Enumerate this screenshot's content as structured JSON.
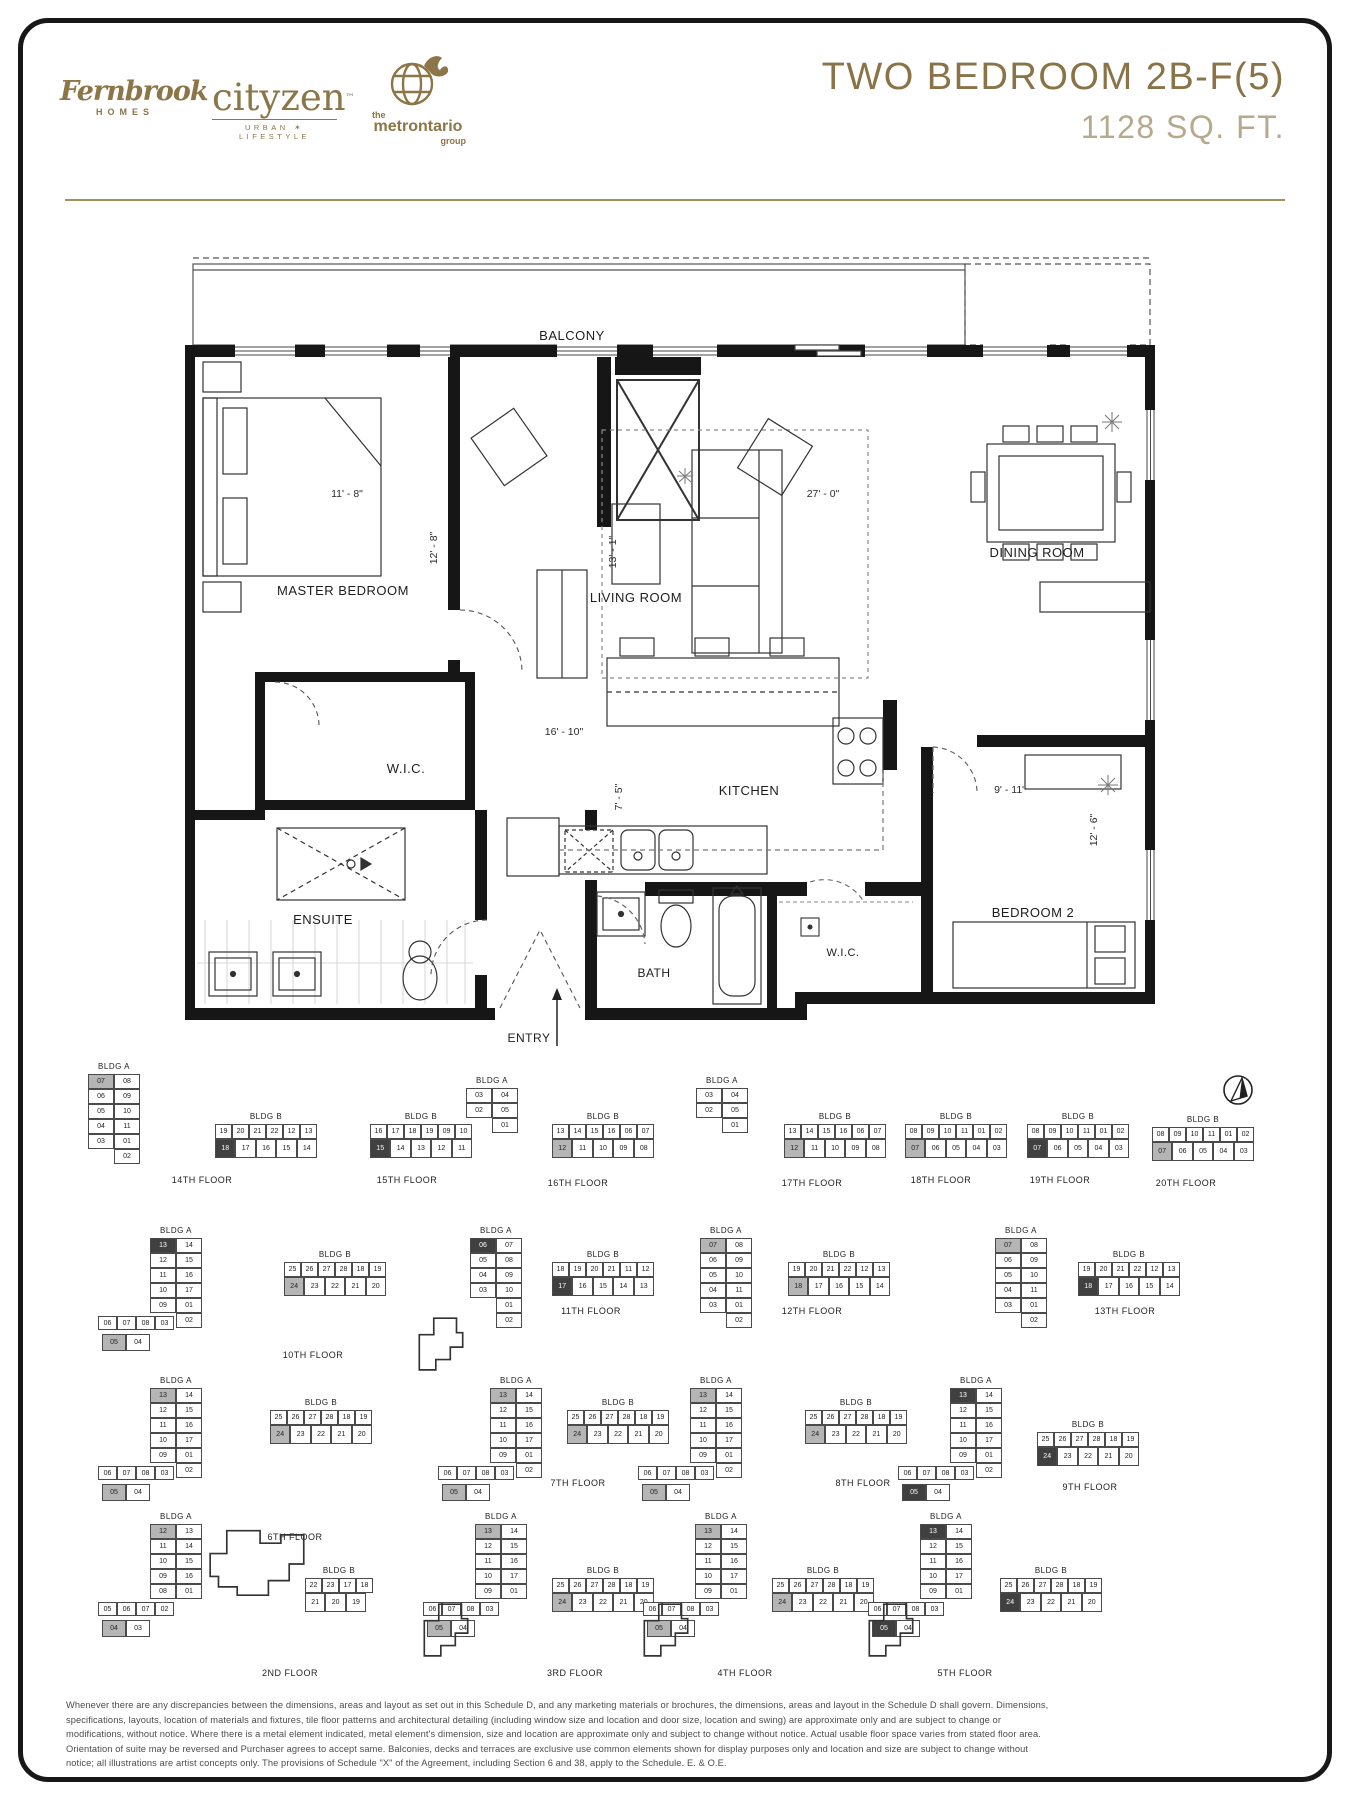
{
  "header": {
    "title": "TWO BEDROOM 2B-F(5)",
    "subtitle": "1128 SQ. FT.",
    "logos": {
      "fernbrook_line1": "Fernbrook",
      "fernbrook_line2": "HOMES",
      "cityzen_line1": "cityzen",
      "cityzen_tm": "™",
      "cityzen_line2": "URBAN ✶ LIFESTYLE",
      "metro_line0": "the",
      "metro_line1": "metrontario",
      "metro_line2": "group"
    },
    "accent_color": "#8a7347",
    "subtitle_color": "#b7a98d"
  },
  "floorplan": {
    "rooms": [
      {
        "t": "BALCONY",
        "x": 407,
        "y": 110,
        "fs": 13
      },
      {
        "t": "MASTER BEDROOM",
        "x": 178,
        "y": 365,
        "fs": 13
      },
      {
        "t": "LIVING ROOM",
        "x": 471,
        "y": 372,
        "fs": 13
      },
      {
        "t": "DINING ROOM",
        "x": 872,
        "y": 327,
        "fs": 13
      },
      {
        "t": "W.I.C.",
        "x": 241,
        "y": 543,
        "fs": 13
      },
      {
        "t": "KITCHEN",
        "x": 584,
        "y": 565,
        "fs": 13
      },
      {
        "t": "ENSUITE",
        "x": 158,
        "y": 694,
        "fs": 13
      },
      {
        "t": "BATH",
        "x": 489,
        "y": 747,
        "fs": 12
      },
      {
        "t": "W.I.C.",
        "x": 678,
        "y": 726,
        "fs": 11
      },
      {
        "t": "BEDROOM 2",
        "x": 868,
        "y": 687,
        "fs": 13
      },
      {
        "t": "ENTRY",
        "x": 364,
        "y": 812,
        "fs": 12
      }
    ],
    "dims": [
      {
        "t": "11' - 8\"",
        "x": 182,
        "y": 267,
        "rot": 0
      },
      {
        "t": "12' - 8\"",
        "x": 272,
        "y": 318,
        "rot": -90
      },
      {
        "t": "13' - 1\"",
        "x": 451,
        "y": 322,
        "rot": -90
      },
      {
        "t": "27' - 0\"",
        "x": 658,
        "y": 267,
        "rot": 0
      },
      {
        "t": "16' - 10\"",
        "x": 399,
        "y": 505,
        "rot": 0
      },
      {
        "t": "7' - 5\"",
        "x": 457,
        "y": 567,
        "rot": -90
      },
      {
        "t": "9' - 11\"",
        "x": 845,
        "y": 563,
        "rot": 0
      },
      {
        "t": "12' - 6\"",
        "x": 932,
        "y": 600,
        "rot": -90
      }
    ]
  },
  "keyplans": {
    "bldga_label": "BLDG A",
    "bldgb_label": "BLDG B",
    "groups": [
      {
        "floor": "14TH FLOOR",
        "fx": 202,
        "fy": 1175,
        "a": {
          "x": 88,
          "y": 1062,
          "left": [
            "07*g",
            "06",
            "05",
            "04",
            "03"
          ],
          "right": [
            "08",
            "09",
            "10",
            "11",
            "01",
            "02"
          ]
        },
        "b": {
          "x": 215,
          "y": 1112,
          "top": [
            "19",
            "20",
            "21",
            "22",
            "12",
            "13"
          ],
          "bottom": [
            "18*d",
            "17",
            "16",
            "15",
            "14"
          ]
        }
      },
      {
        "floor": "15TH FLOOR",
        "fx": 407,
        "fy": 1175,
        "b": {
          "x": 370,
          "y": 1112,
          "top": [
            "16",
            "17",
            "18",
            "19",
            "09",
            "10"
          ],
          "bottom": [
            "15*d",
            "14",
            "13",
            "12",
            "11"
          ]
        }
      },
      {
        "floor": "16TH FLOOR",
        "fx": 578,
        "fy": 1178,
        "a": {
          "x": 466,
          "y": 1076,
          "left": [
            "03",
            "02"
          ],
          "right": [
            "04",
            "05",
            "01"
          ]
        },
        "b": {
          "x": 552,
          "y": 1112,
          "top": [
            "13",
            "14",
            "15",
            "16",
            "06",
            "07"
          ],
          "bottom": [
            "12*g",
            "11",
            "10",
            "09",
            "08"
          ]
        }
      },
      {
        "floor": "17TH FLOOR",
        "fx": 812,
        "fy": 1178,
        "a": {
          "x": 696,
          "y": 1076,
          "left": [
            "03",
            "02"
          ],
          "right": [
            "04",
            "05",
            "01"
          ]
        },
        "b": {
          "x": 784,
          "y": 1112,
          "top": [
            "13",
            "14",
            "15",
            "16",
            "06",
            "07"
          ],
          "bottom": [
            "12*g",
            "11",
            "10",
            "09",
            "08"
          ]
        }
      },
      {
        "floor": "18TH FLOOR",
        "fx": 941,
        "fy": 1175,
        "b": {
          "x": 905,
          "y": 1112,
          "top": [
            "08",
            "09",
            "10",
            "11",
            "01",
            "02"
          ],
          "bottom": [
            "07*g",
            "06",
            "05",
            "04",
            "03"
          ]
        }
      },
      {
        "floor": "19TH FLOOR",
        "fx": 1060,
        "fy": 1175,
        "b": {
          "x": 1027,
          "y": 1112,
          "top": [
            "08",
            "09",
            "10",
            "11",
            "01",
            "02"
          ],
          "bottom": [
            "07*d",
            "06",
            "05",
            "04",
            "03"
          ]
        }
      },
      {
        "floor": "20TH FLOOR",
        "fx": 1186,
        "fy": 1178,
        "b": {
          "x": 1152,
          "y": 1115,
          "top": [
            "08",
            "09",
            "10",
            "11",
            "01",
            "02"
          ],
          "bottom": [
            "07*g",
            "06",
            "05",
            "04",
            "03"
          ]
        }
      },
      {
        "floor": "10TH FLOOR",
        "fx": 313,
        "fy": 1350,
        "a": {
          "x": 150,
          "y": 1226,
          "left": [
            "13*d",
            "12",
            "11",
            "10",
            "09"
          ],
          "right": [
            "14",
            "15",
            "16",
            "17",
            "01",
            "02"
          ],
          "arm": [
            "06",
            "07",
            "08",
            "03"
          ],
          "arm2": [
            "05*g",
            "04"
          ]
        },
        "b": {
          "x": 284,
          "y": 1250,
          "top": [
            "25",
            "26",
            "27",
            "28",
            "18",
            "19"
          ],
          "bottom": [
            "24*g",
            "23",
            "22",
            "21",
            "20"
          ]
        }
      },
      {
        "floor": "11TH FLOOR",
        "fx": 591,
        "fy": 1306,
        "a": {
          "x": 470,
          "y": 1226,
          "left": [
            "06*d",
            "05",
            "04",
            "03"
          ],
          "right": [
            "07",
            "08",
            "09",
            "10",
            "01",
            "02"
          ],
          "podium": "small-left"
        },
        "b": {
          "x": 552,
          "y": 1250,
          "top": [
            "18",
            "19",
            "20",
            "21",
            "11",
            "12"
          ],
          "bottom": [
            "17*d",
            "16",
            "15",
            "14",
            "13"
          ]
        }
      },
      {
        "floor": "12TH FLOOR",
        "fx": 812,
        "fy": 1306,
        "a": {
          "x": 700,
          "y": 1226,
          "left": [
            "07*g",
            "06",
            "05",
            "04",
            "03"
          ],
          "right": [
            "08",
            "09",
            "10",
            "11",
            "01",
            "02"
          ]
        },
        "b": {
          "x": 788,
          "y": 1250,
          "top": [
            "19",
            "20",
            "21",
            "22",
            "12",
            "13"
          ],
          "bottom": [
            "18*g",
            "17",
            "16",
            "15",
            "14"
          ]
        }
      },
      {
        "floor": "13TH FLOOR",
        "fx": 1125,
        "fy": 1306,
        "a": {
          "x": 995,
          "y": 1226,
          "left": [
            "07*g",
            "06",
            "05",
            "04",
            "03"
          ],
          "right": [
            "08",
            "09",
            "10",
            "11",
            "01",
            "02"
          ]
        },
        "b": {
          "x": 1078,
          "y": 1250,
          "top": [
            "19",
            "20",
            "21",
            "22",
            "12",
            "13"
          ],
          "bottom": [
            "18*d",
            "17",
            "16",
            "15",
            "14"
          ]
        }
      },
      {
        "floor": "6TH FLOOR",
        "fx": 295,
        "fy": 1532,
        "a": {
          "x": 150,
          "y": 1376,
          "left": [
            "13*g",
            "12",
            "11",
            "10",
            "09"
          ],
          "right": [
            "14",
            "15",
            "16",
            "17",
            "01",
            "02"
          ],
          "arm": [
            "06",
            "07",
            "08",
            "03"
          ],
          "arm2": [
            "05*g",
            "04"
          ]
        },
        "b": {
          "x": 270,
          "y": 1398,
          "top": [
            "25",
            "26",
            "27",
            "28",
            "18",
            "19"
          ],
          "bottom": [
            "24*g",
            "23",
            "22",
            "21",
            "20"
          ]
        }
      },
      {
        "floor": "7TH FLOOR",
        "fx": 578,
        "fy": 1478,
        "a": {
          "x": 490,
          "y": 1376,
          "left": [
            "13*g",
            "12",
            "11",
            "10",
            "09"
          ],
          "right": [
            "14",
            "15",
            "16",
            "17",
            "01",
            "02"
          ],
          "arm": [
            "06",
            "07",
            "08",
            "03"
          ],
          "arm2": [
            "05*g",
            "04"
          ]
        },
        "b": {
          "x": 567,
          "y": 1398,
          "top": [
            "25",
            "26",
            "27",
            "28",
            "18",
            "19"
          ],
          "bottom": [
            "24*g",
            "23",
            "22",
            "21",
            "20"
          ]
        }
      },
      {
        "floor": "8TH FLOOR",
        "fx": 863,
        "fy": 1478,
        "a": {
          "x": 690,
          "y": 1376,
          "left": [
            "13*g",
            "12",
            "11",
            "10",
            "09"
          ],
          "right": [
            "14",
            "15",
            "16",
            "17",
            "01",
            "02"
          ],
          "arm": [
            "06",
            "07",
            "08",
            "03"
          ],
          "arm2": [
            "05*g",
            "04"
          ]
        },
        "b": {
          "x": 805,
          "y": 1398,
          "top": [
            "25",
            "26",
            "27",
            "28",
            "18",
            "19"
          ],
          "bottom": [
            "24*g",
            "23",
            "22",
            "21",
            "20"
          ]
        }
      },
      {
        "floor": "9TH FLOOR",
        "fx": 1090,
        "fy": 1482,
        "a": {
          "x": 950,
          "y": 1376,
          "left": [
            "13*d",
            "12",
            "11",
            "10",
            "09"
          ],
          "right": [
            "14",
            "15",
            "16",
            "17",
            "01",
            "02"
          ],
          "arm": [
            "06",
            "07",
            "08",
            "03"
          ],
          "arm2": [
            "05*d",
            "04"
          ]
        },
        "b": {
          "x": 1037,
          "y": 1420,
          "top": [
            "25",
            "26",
            "27",
            "28",
            "18",
            "19"
          ],
          "bottom": [
            "24*d",
            "23",
            "22",
            "21",
            "20"
          ]
        }
      },
      {
        "floor": "2ND FLOOR",
        "fx": 290,
        "fy": 1668,
        "a": {
          "x": 150,
          "y": 1512,
          "left": [
            "12*g",
            "11",
            "10",
            "09",
            "08"
          ],
          "right": [
            "13",
            "14",
            "15",
            "16",
            "01"
          ],
          "arm": [
            "05",
            "06",
            "07",
            "02"
          ],
          "arm2": [
            "04*g",
            "03"
          ],
          "podium": "big-right"
        },
        "b": {
          "x": 305,
          "y": 1566,
          "top": [
            "22",
            "23",
            "17",
            "18"
          ],
          "bottom": [
            "21",
            "20",
            "19"
          ]
        }
      },
      {
        "floor": "3RD FLOOR",
        "fx": 575,
        "fy": 1668,
        "a": {
          "x": 475,
          "y": 1512,
          "left": [
            "13*g",
            "12",
            "11",
            "10",
            "09"
          ],
          "right": [
            "14",
            "15",
            "16",
            "17",
            "01"
          ],
          "arm": [
            "06",
            "07",
            "08",
            "03"
          ],
          "arm2": [
            "05*g",
            "04"
          ],
          "podium": "small-left"
        },
        "b": {
          "x": 552,
          "y": 1566,
          "top": [
            "25",
            "26",
            "27",
            "28",
            "18",
            "19"
          ],
          "bottom": [
            "24*g",
            "23",
            "22",
            "21",
            "20"
          ]
        }
      },
      {
        "floor": "4TH FLOOR",
        "fx": 745,
        "fy": 1668,
        "a": {
          "x": 695,
          "y": 1512,
          "left": [
            "13*g",
            "12",
            "11",
            "10",
            "09"
          ],
          "right": [
            "14",
            "15",
            "16",
            "17",
            "01"
          ],
          "arm": [
            "06",
            "07",
            "08",
            "03"
          ],
          "arm2": [
            "05*g",
            "04"
          ],
          "podium": "small-left"
        },
        "b": {
          "x": 772,
          "y": 1566,
          "top": [
            "25",
            "26",
            "27",
            "28",
            "18",
            "19"
          ],
          "bottom": [
            "24*g",
            "23",
            "22",
            "21",
            "20"
          ]
        }
      },
      {
        "floor": "5TH FLOOR",
        "fx": 965,
        "fy": 1668,
        "a": {
          "x": 920,
          "y": 1512,
          "left": [
            "13*d",
            "12",
            "11",
            "10",
            "09"
          ],
          "right": [
            "14",
            "15",
            "16",
            "17",
            "01"
          ],
          "arm": [
            "06",
            "07",
            "08",
            "03"
          ],
          "arm2": [
            "05*d",
            "04"
          ],
          "podium": "small-left"
        },
        "b": {
          "x": 1000,
          "y": 1566,
          "top": [
            "25",
            "26",
            "27",
            "28",
            "18",
            "19"
          ],
          "bottom": [
            "24*d",
            "23",
            "22",
            "21",
            "20"
          ]
        }
      }
    ]
  },
  "disclaimer": [
    "Whenever there are any discrepancies between the dimensions, areas and layout as set out in this Schedule D, and any marketing materials or brochures, the dimensions, areas and layout in the Schedule D shall govern. Dimensions,",
    "specifications, layouts, location of materials and fixtures, tile floor patterns and architectural detailing (including window size and location and door size, location and swing) are approximate only and are subject to change or",
    "modifications, without notice. Where there is a metal element indicated, metal element's dimension, size and location are approximate only and subject to change without notice. Actual usable floor space varies from stated floor area.",
    "Orientation of suite may be reversed and Purchaser agrees to accept same. Balconies, decks and terraces are exclusive use common elements shown for display purposes only and location and size are subject to change without",
    "notice; all illustrations are artist concepts only. The provisions of Schedule \"X\" of the Agreement, including Section 6 and 38, apply to the Schedule. E. & O.E."
  ]
}
